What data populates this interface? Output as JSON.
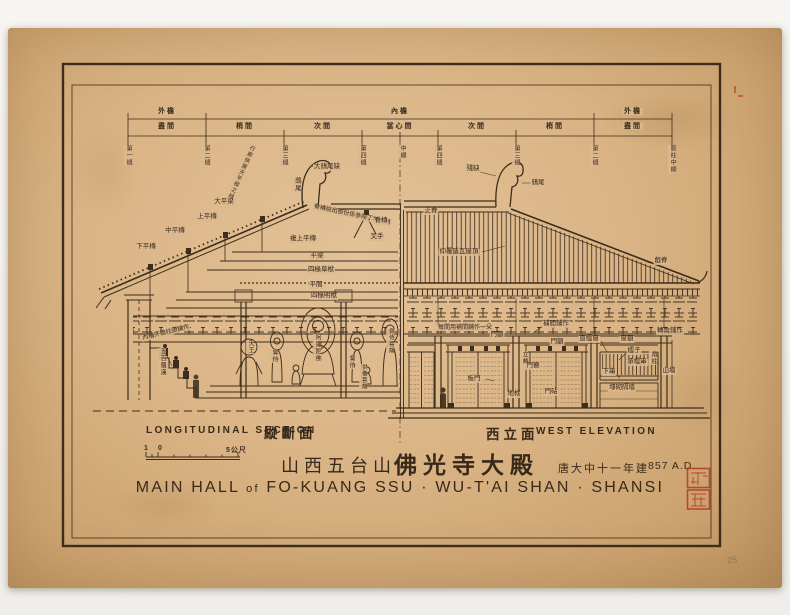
{
  "colors": {
    "paper": "#dbb78c",
    "ink": "#3c2d1c",
    "seal_red": "#b5412c"
  },
  "dimensions": {
    "row1": [
      {
        "label": "外檐",
        "x": 167
      },
      {
        "label": "內檐",
        "x": 400
      },
      {
        "label": "外檐",
        "x": 633
      }
    ],
    "row2": [
      {
        "label": "盡間",
        "x": 167
      },
      {
        "label": "梢間",
        "x": 245
      },
      {
        "label": "次間",
        "x": 323
      },
      {
        "label": "當心間",
        "x": 400
      },
      {
        "label": "次間",
        "x": 477
      },
      {
        "label": "梢間",
        "x": 555
      },
      {
        "label": "盡間",
        "x": 633
      }
    ],
    "axes": [
      {
        "t": "第一縫",
        "x": 128
      },
      {
        "t": "第二縫",
        "x": 206
      },
      {
        "t": "行廊挾屋天平樑之縫",
        "x": 252,
        "diag": 1,
        "s": 5.5
      },
      {
        "t": "第三縫",
        "x": 284
      },
      {
        "t": "第四縫",
        "x": 362
      },
      {
        "t": "中線",
        "x": 402
      },
      {
        "t": "第四縫",
        "x": 438
      },
      {
        "t": "第三縫",
        "x": 516
      },
      {
        "t": "第二縫",
        "x": 594
      },
      {
        "t": "簷柱中線",
        "x": 672
      }
    ]
  },
  "annotations": [
    {
      "t": "大鴟尾缺",
      "x": 327,
      "y": 164
    },
    {
      "t": "鴟尾",
      "x": 296,
      "y": 177,
      "v": 1
    },
    {
      "t": "脊槫挑出部份係參照丁村木構",
      "x": 352,
      "y": 212,
      "r": 12,
      "s": 6
    },
    {
      "t": "大平梁",
      "x": 224,
      "y": 199
    },
    {
      "t": "上平槫",
      "x": 207,
      "y": 214
    },
    {
      "t": "中平槫",
      "x": 175,
      "y": 228
    },
    {
      "t": "下平槫",
      "x": 146,
      "y": 244
    },
    {
      "t": "脊槫",
      "x": 381,
      "y": 218
    },
    {
      "t": "叉手",
      "x": 377,
      "y": 234
    },
    {
      "t": "複上平槫",
      "x": 303,
      "y": 236
    },
    {
      "t": "平梁",
      "x": 317,
      "y": 253
    },
    {
      "t": "四椽草栿",
      "x": 321,
      "y": 267
    },
    {
      "t": "平闇",
      "x": 316,
      "y": 282
    },
    {
      "t": "四椽明栿",
      "x": 324,
      "y": 293
    },
    {
      "t": "內槽外檐柱頭鋪作",
      "x": 166,
      "y": 330,
      "r": -14,
      "s": 6
    },
    {
      "t": "五百羅漢",
      "x": 162,
      "y": 348,
      "v": 1,
      "s": 6
    },
    {
      "t": "天王",
      "x": 250,
      "y": 340,
      "v": 1,
      "s": 6
    },
    {
      "t": "脅侍",
      "x": 274,
      "y": 349,
      "v": 1,
      "s": 6
    },
    {
      "t": "阿彌陀佛",
      "x": 317,
      "y": 334,
      "v": 1,
      "s": 6
    },
    {
      "t": "脅侍",
      "x": 351,
      "y": 355,
      "v": 1,
      "s": 6
    },
    {
      "t": "供養菩薩",
      "x": 363,
      "y": 364,
      "v": 1,
      "s": 5.5
    },
    {
      "t": "脅侍菩薩",
      "x": 390,
      "y": 328,
      "v": 1,
      "s": 5.5
    },
    {
      "t": "殘缺",
      "x": 473,
      "y": 166
    },
    {
      "t": "鴟尾",
      "x": 538,
      "y": 180
    },
    {
      "t": "正脊",
      "x": 431,
      "y": 208
    },
    {
      "t": "仰覆瓪瓦屋頂",
      "x": 459,
      "y": 249
    },
    {
      "t": "戧脊",
      "x": 661,
      "y": 258
    },
    {
      "t": "補間鋪作",
      "x": 556,
      "y": 321
    },
    {
      "t": "每間用補間鋪作一朵",
      "x": 465,
      "y": 325,
      "s": 6
    },
    {
      "t": "轉角鋪作",
      "x": 670,
      "y": 328
    },
    {
      "t": "門額",
      "x": 497,
      "y": 332
    },
    {
      "t": "門額",
      "x": 557,
      "y": 339
    },
    {
      "t": "立頰",
      "x": 524,
      "y": 351,
      "v": 1,
      "s": 6
    },
    {
      "t": "門簪",
      "x": 533,
      "y": 363
    },
    {
      "t": "板門",
      "x": 474,
      "y": 376
    },
    {
      "t": "地栿",
      "x": 514,
      "y": 391
    },
    {
      "t": "門砧",
      "x": 551,
      "y": 389
    },
    {
      "t": "直櫺窗",
      "x": 589,
      "y": 336
    },
    {
      "t": "窗額",
      "x": 627,
      "y": 336
    },
    {
      "t": "櫺子",
      "x": 634,
      "y": 348
    },
    {
      "t": "承櫺串",
      "x": 637,
      "y": 359
    },
    {
      "t": "下串",
      "x": 609,
      "y": 369
    },
    {
      "t": "塼砌隔墻",
      "x": 622,
      "y": 385
    },
    {
      "t": "角柱",
      "x": 653,
      "y": 351,
      "v": 1,
      "s": 6
    },
    {
      "t": "山墻",
      "x": 669,
      "y": 368
    }
  ],
  "captions": {
    "section_en": "LONGITUDINAL SECTION",
    "section_zh": "縱斷面",
    "elevation_zh": "西立面",
    "elevation_en": "WEST ELEVATION",
    "scale_one": "1",
    "scale_zero": "0",
    "scale_five": "5公尺"
  },
  "title": {
    "zh_location": "山西五台山",
    "zh_name": "佛光寺大殿",
    "zh_date": "唐大中十一年建",
    "en_date": "857 A.D.",
    "en_main": "MAIN HALL",
    "en_of": "of",
    "en_rest": "FO-KUANG SSU · WU-T'AI SHAN · SHANSI"
  },
  "margin_note": "25"
}
